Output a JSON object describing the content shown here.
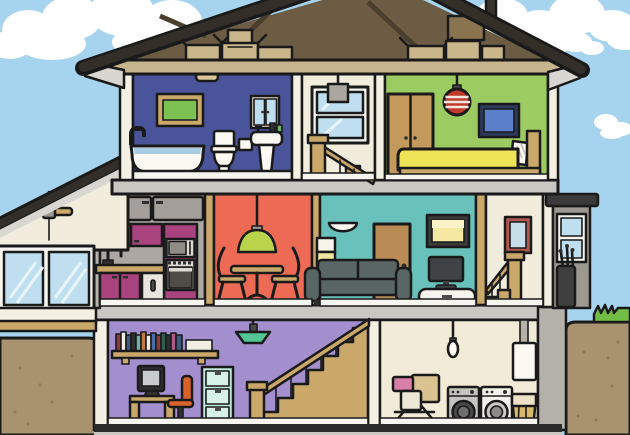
{
  "title": "Cutaway cross-section illustration of a two-storey house with attic and basement",
  "palette": {
    "sky": "#A6D4EE",
    "cloud": "#FFFFFF",
    "outline": "#1A1A1A",
    "roof_band": "#332E28",
    "attic_floor": "#C5B48C",
    "box_tan": "#C9B68B",
    "box_dark": "#8A734F",
    "structure_gray": "#C9C7C2",
    "wall_white": "#F4F0E3",
    "soffit": "#D8D6D0",
    "earth": "#A8936E",
    "earth_speckle": "#8F7B57",
    "grass": "#72BE44",
    "foundation": "#B4B1AA",
    "floor_strip": "#F7F5EF",
    "basement_floor": "#2B2B2B"
  },
  "rooms": [
    {
      "id": "attic",
      "name": "attic",
      "wall": "#6C5C44",
      "items": [
        "storage boxes",
        "rafters"
      ]
    },
    {
      "id": "bathroom",
      "name": "bathroom",
      "wall": "#4A549B",
      "items": [
        "ceiling light",
        "picture",
        "mirror cabinet",
        "bathtub",
        "toilet",
        "toilet paper holder",
        "pedestal sink"
      ]
    },
    {
      "id": "landing",
      "name": "stair landing",
      "wall": "#F1ECDB",
      "items": [
        "pendant lamp",
        "window",
        "banister",
        "stairs"
      ]
    },
    {
      "id": "bedroom",
      "name": "bedroom",
      "wall": "#9CCB62",
      "items": [
        "wardrobe",
        "paper lantern",
        "picture",
        "bed"
      ]
    },
    {
      "id": "sunroom",
      "name": "conservatory",
      "wall": "#F1ECDB",
      "items": [
        "ceiling fan",
        "picture windows"
      ]
    },
    {
      "id": "kitchen",
      "name": "kitchen",
      "wall": "#ACA7A3",
      "cabinet": "#A8437D",
      "items": [
        "cupboards",
        "sink",
        "counter",
        "microwave",
        "oven",
        "dishwasher"
      ]
    },
    {
      "id": "dining",
      "name": "dining room",
      "wall": "#ED6A55",
      "items": [
        "pendant lamp",
        "pedestal table",
        "chairs"
      ]
    },
    {
      "id": "living",
      "name": "living room",
      "wall": "#68C2BB",
      "items": [
        "wall light",
        "floor lamp",
        "sofa",
        "door",
        "picture",
        "tv",
        "tv console"
      ]
    },
    {
      "id": "hallway",
      "name": "hallway",
      "wall": "#F1ECDB",
      "items": [
        "framed mirror",
        "banister",
        "steps"
      ]
    },
    {
      "id": "porch",
      "name": "side porch",
      "wall": "#9C9890",
      "items": [
        "window",
        "golf bag"
      ]
    },
    {
      "id": "office",
      "name": "basement office",
      "wall": "#A48FCE",
      "items": [
        "bookshelf",
        "pendant lamp",
        "computer",
        "desk",
        "office chair",
        "filing cabinet",
        "staircase"
      ]
    },
    {
      "id": "laundry",
      "name": "laundry room",
      "wall": "#F2EBD8",
      "items": [
        "light bulb",
        "boiler",
        "drying rack",
        "washing machine",
        "tumble dryer",
        "laundry basket"
      ]
    }
  ],
  "objects": {
    "wardrobe": "#C49A5C",
    "lantern": "#C0392B",
    "bed_blanket": "#EFE457",
    "bed_frame": "#C9A86A",
    "picture_green": "#7CC152",
    "picture_blue": "#5C7FC9",
    "picture_yellow": "#F5E8A2",
    "dining_lamp": "#B9D44B",
    "office_lamp": "#52C795",
    "sofa": "#5A6664",
    "door": "#B98C56",
    "chair_orange": "#D9622B",
    "filing_cabinet": "#BFE8DC",
    "water_blue": "#A9CBE4",
    "glass_blue": "#BFDFF0",
    "wood_tan": "#C9A86A",
    "mirror_frame": "#B0584F",
    "towel_pink": "#D87FA8",
    "towel_tan": "#D8C391",
    "basket": "#D9B96A"
  }
}
